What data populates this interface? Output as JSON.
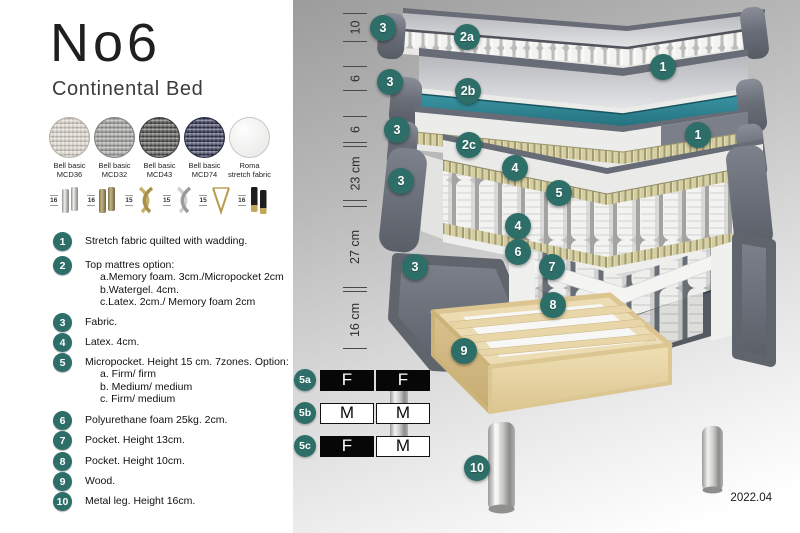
{
  "accent_color": "#2E6E68",
  "header": {
    "title": "No6",
    "subtitle": "Continental Bed"
  },
  "fabrics": [
    {
      "name": "Bell basic",
      "code": "MCD36",
      "color": "#d8d3c8"
    },
    {
      "name": "Bell basic",
      "code": "MCD32",
      "color": "#9c9c9a"
    },
    {
      "name": "Bell basic",
      "code": "MCD43",
      "color": "#4c4c4a"
    },
    {
      "name": "Bell basic",
      "code": "MCD74",
      "color": "#2f3350"
    },
    {
      "name": "Roma",
      "code": "stretch fabric",
      "color": "#f2f2f0"
    }
  ],
  "legs": [
    {
      "height": "16",
      "type": "silver-cylinder-leg"
    },
    {
      "height": "16",
      "type": "brass-cylinder-leg"
    },
    {
      "height": "15",
      "type": "gold-twist-leg"
    },
    {
      "height": "15",
      "type": "silver-twist-leg"
    },
    {
      "height": "15",
      "type": "gold-hairpin-leg"
    },
    {
      "height": "16",
      "type": "black-gold-cylinder-leg"
    }
  ],
  "legend": {
    "items": [
      {
        "num": "1",
        "text": "Stretch fabric quilted with wadding."
      },
      {
        "num": "2",
        "text": "Top mattres option:",
        "sub": [
          "a.Memory foam. 3cm./Micropocket 2cm",
          "b.Watergel. 4cm.",
          "c.Latex. 2cm./ Memory foam 2cm"
        ]
      },
      {
        "num": "3",
        "text": "Fabric."
      },
      {
        "num": "4",
        "text": "Latex. 4cm."
      },
      {
        "num": "5",
        "text": "Micropocket. Height 15 cm. 7zones. Option:",
        "sub": [
          "a. Firm/ firm",
          "b. Medium/ medium",
          "c. Firm/ medium"
        ]
      },
      {
        "num": "6",
        "text": "Polyurethane foam 25kg. 2cm."
      },
      {
        "num": "7",
        "text": "Pocket. Height 13cm."
      },
      {
        "num": "8",
        "text": "Pocket. Height 10cm."
      },
      {
        "num": "9",
        "text": "Wood."
      },
      {
        "num": "10",
        "text": "Metal leg. Height 16cm."
      }
    ]
  },
  "diagram": {
    "ruler": [
      {
        "label": "10"
      },
      {
        "label": "6"
      },
      {
        "label": "6"
      },
      {
        "label": "23 cm"
      },
      {
        "label": "27 cm"
      },
      {
        "label": "16 cm"
      }
    ],
    "callouts": [
      {
        "id": "fabric-top-layer",
        "label": "3"
      },
      {
        "id": "fabric-watergel-layer",
        "label": "3"
      },
      {
        "id": "fabric-2c-layer",
        "label": "3"
      },
      {
        "id": "fabric-main-mattress",
        "label": "3"
      },
      {
        "id": "fabric-base",
        "label": "3"
      },
      {
        "id": "top-option-a",
        "label": "2a"
      },
      {
        "id": "top-option-b",
        "label": "2b"
      },
      {
        "id": "top-option-c",
        "label": "2c"
      },
      {
        "id": "stretch-fabric-upper",
        "label": "1"
      },
      {
        "id": "stretch-fabric-lower",
        "label": "1"
      },
      {
        "id": "latex-top",
        "label": "4"
      },
      {
        "id": "micropocket",
        "label": "5"
      },
      {
        "id": "latex-bottom",
        "label": "4"
      },
      {
        "id": "polyurethane-foam",
        "label": "6"
      },
      {
        "id": "pocket-13",
        "label": "7"
      },
      {
        "id": "pocket-10",
        "label": "8"
      },
      {
        "id": "wood-frame",
        "label": "9"
      },
      {
        "id": "metal-leg",
        "label": "10"
      }
    ],
    "firmness_options": [
      {
        "id": "5a",
        "left": {
          "text": "F",
          "fill": "dark"
        },
        "right": {
          "text": "F",
          "fill": "dark"
        }
      },
      {
        "id": "5b",
        "left": {
          "text": "M",
          "fill": "light"
        },
        "right": {
          "text": "M",
          "fill": "light"
        }
      },
      {
        "id": "5c",
        "left": {
          "text": "F",
          "fill": "dark"
        },
        "right": {
          "text": "M",
          "fill": "light"
        }
      }
    ],
    "colors": {
      "watergel": "#2F8291",
      "upholstery": "#676B75",
      "latex": "#D6CFA2",
      "wood": "#EAD9B0"
    },
    "version": "2022.04"
  }
}
